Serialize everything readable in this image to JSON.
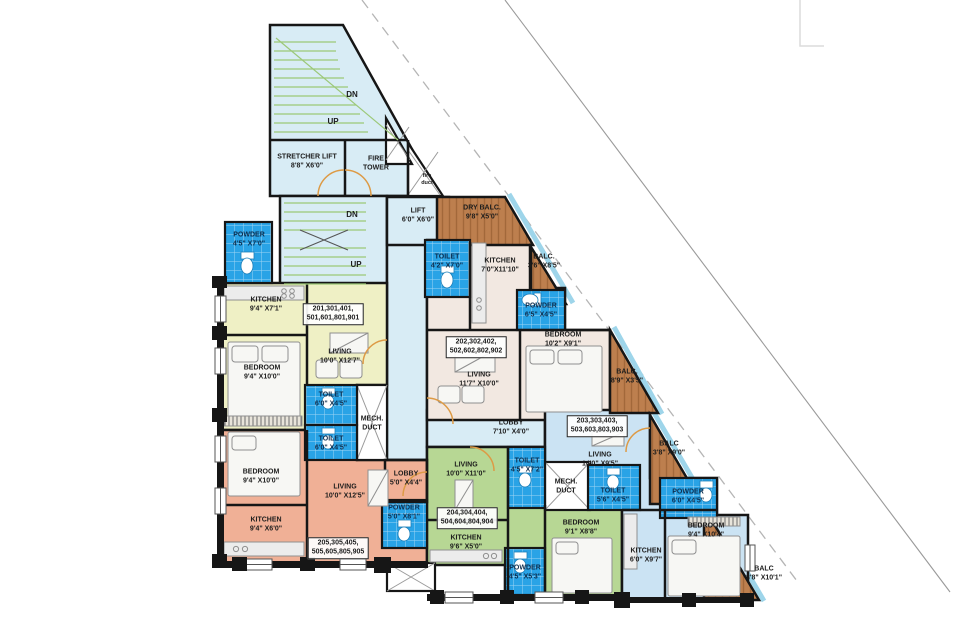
{
  "plan": {
    "stairs": {
      "dn": "DN",
      "up": "UP"
    },
    "stretcher_lift": {
      "name": "STRETCHER LIFT",
      "dims": "8'8\" X6'0\""
    },
    "fire_tower": {
      "line1": "FIRE",
      "line2": "TOWER"
    },
    "fire_duct": {
      "line1": "fire",
      "line2": "duct"
    },
    "lift": {
      "name": "LIFT",
      "dims": "6'0\" X6'0\""
    },
    "lobby": {
      "name": "LOBBY",
      "dims": "7'10\" X4'0\""
    },
    "mech_duct": {
      "line1": "MECH.",
      "line2": "DUCT"
    }
  },
  "units": {
    "u201": {
      "numbers": [
        "201,301,401,",
        "501,601,801,901"
      ],
      "powder": {
        "name": "POWDER",
        "dims": "4'5\" X7'0\""
      },
      "kitchen": {
        "name": "KITCHEN",
        "dims": "9'4\" X7'1\""
      },
      "living": {
        "name": "LIVING",
        "dims": "10'0\" X12'7\""
      },
      "bedroom": {
        "name": "BEDROOM",
        "dims": "9'4\" X10'0\""
      },
      "toilet": {
        "name": "TOILET",
        "dims": "6'0\" X4'5\""
      }
    },
    "u202": {
      "numbers": [
        "202,302,402,",
        "502,602,802,902"
      ],
      "toilet": {
        "name": "TOILET",
        "dims": "4'2\" X7'0\""
      },
      "dry_balcony": {
        "name": "DRY BALC.",
        "dims": "9'8\" X5'0\""
      },
      "kitchen": {
        "name": "KITCHEN",
        "dims": "7'0\"X11'10\""
      },
      "balcony1": {
        "name": "BALC.",
        "dims": "3'6\" X8'5\""
      },
      "powder": {
        "name": "POWDER",
        "dims": "6'5\" X4'5\""
      },
      "living": {
        "name": "LIVING",
        "dims": "11'7\" X10'0\""
      },
      "bedroom": {
        "name": "BEDROOM",
        "dims": "10'2\" X9'1\""
      },
      "balcony2": {
        "name": "BALC.",
        "dims": "8'9\" X3'5\""
      }
    },
    "u203": {
      "numbers": [
        "203,303,403,",
        "503,603,803,903"
      ],
      "living": {
        "name": "LIVING",
        "dims": "14'0\" X9'5\""
      },
      "toilet": {
        "name": "TOILET",
        "dims": "5'6\" X4'5\""
      },
      "powder": {
        "name": "POWDER",
        "dims": "6'0\" X4'5\""
      },
      "bedroom": {
        "name": "BEDROOM",
        "dims": "9'4\" X10'4\""
      },
      "kitchen": {
        "name": "KITCHEN",
        "dims": "6'0\" X9'7\""
      },
      "balcony1": {
        "name": "BALC",
        "dims": "3'8\" X9'0\""
      },
      "balcony2": {
        "name": "BALC",
        "dims": "3'8\" X10'1\""
      }
    },
    "u204": {
      "numbers": [
        "204,304,404,",
        "504,604,804,904"
      ],
      "living": {
        "name": "LIVING",
        "dims": "10'0\" X11'0\""
      },
      "toilet": {
        "name": "TOILET",
        "dims": "4'5\" X7'2\""
      },
      "kitchen": {
        "name": "KITCHEN",
        "dims": "9'6\" X5'0\""
      },
      "bedroom": {
        "name": "BEDROOM",
        "dims": "9'1\" X8'8\""
      },
      "powder": {
        "name": "POWDER",
        "dims": "4'5\" X5'3\""
      }
    },
    "u205": {
      "numbers": [
        "205,305,405,",
        "505,605,805,905"
      ],
      "toilet": {
        "name": "TOILET",
        "dims": "6'0\" X4'5\""
      },
      "bedroom": {
        "name": "BEDROOM",
        "dims": "9'4\" X10'0\""
      },
      "living": {
        "name": "LIVING",
        "dims": "10'0\" X12'5\""
      },
      "kitchen": {
        "name": "KITCHEN",
        "dims": "9'4\" X6'0\""
      },
      "lobby": {
        "name": "LOBBY",
        "dims": "5'0\" X4'4\""
      },
      "powder": {
        "name": "POWDER",
        "dims": "5'0\" X8'1\""
      }
    }
  },
  "colors": {
    "common_area": "#d8ecf5",
    "unit_yellow": "#eff0c5",
    "unit_beige": "#f2e8e1",
    "unit_green": "#b7d794",
    "unit_blue": "#cbe3f3",
    "unit_salmon": "#f0b096",
    "wet_area_blue": "#29a3e6",
    "balcony_brown": "#bd7f4e",
    "balcony_edge": "#9ed5ea",
    "wall": "#161616",
    "stair_tread": "#9cc878",
    "door_arc": "#dd9a45"
  }
}
